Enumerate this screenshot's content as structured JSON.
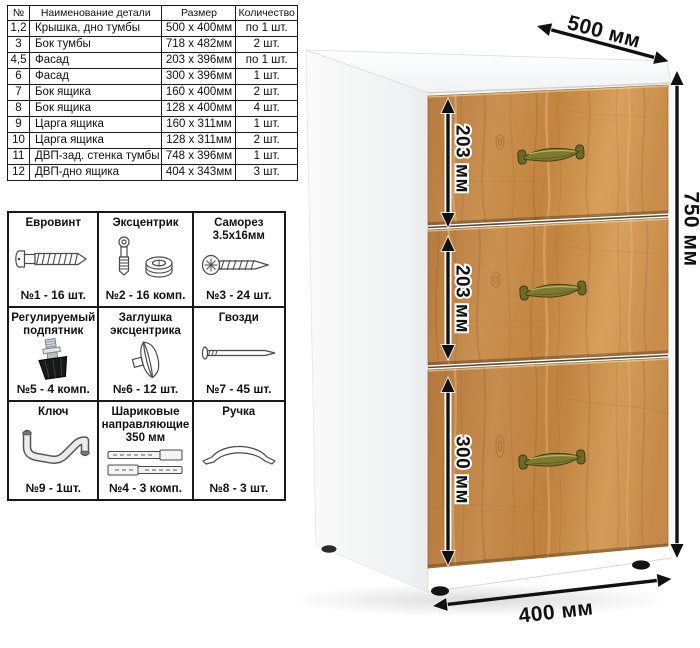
{
  "parts_table": {
    "headers": [
      "№",
      "Наименование детали",
      "Размер",
      "Количество"
    ],
    "rows": [
      {
        "num": "1,2",
        "name": "Крышка, дно тумбы",
        "size": "500 x 400мм",
        "qty": "по 1 шт."
      },
      {
        "num": "3",
        "name": "Бок тумбы",
        "size": "718 x 482мм",
        "qty": "2 шт."
      },
      {
        "num": "4,5",
        "name": "Фасад",
        "size": "203 x 396мм",
        "qty": "по 1 шт."
      },
      {
        "num": "6",
        "name": "Фасад",
        "size": "300 x 396мм",
        "qty": "1 шт."
      },
      {
        "num": "7",
        "name": "Бок ящика",
        "size": "160 x 400мм",
        "qty": "2 шт."
      },
      {
        "num": "8",
        "name": "Бок ящика",
        "size": "128 x 400мм",
        "qty": "4 шт."
      },
      {
        "num": "9",
        "name": "Царга ящика",
        "size": "160 x 311мм",
        "qty": "1 шт."
      },
      {
        "num": "10",
        "name": "Царга ящика",
        "size": "128 x 311мм",
        "qty": "2 шт."
      },
      {
        "num": "11",
        "name": "ДВП-зад. стенка тумбы",
        "size": "748 x 396мм",
        "qty": "1 шт."
      },
      {
        "num": "12",
        "name": "ДВП-дно ящика",
        "size": "404 x 343мм",
        "qty": "3 шт."
      }
    ]
  },
  "hardware": {
    "cells": [
      {
        "title": "Евровинт",
        "icon": "euro-screw-icon",
        "count": "№1 - 16 шт."
      },
      {
        "title": "Эксцентрик",
        "icon": "cam-lock-icon",
        "count": "№2 - 16 комп."
      },
      {
        "title": "Саморез 3.5х16мм",
        "icon": "self-tapping-screw-icon",
        "count": "№3 - 24 шт."
      },
      {
        "title": "Регулируемый подпятник",
        "icon": "adjustable-foot-icon",
        "count": "№5 - 4 комп."
      },
      {
        "title": "Заглушка эксцентрика",
        "icon": "cam-cover-icon",
        "count": "№6 - 12 шт."
      },
      {
        "title": "Гвозди",
        "icon": "nail-icon",
        "count": "№7 - 45 шт."
      },
      {
        "title": "Ключ",
        "icon": "hex-key-icon",
        "count": "№9 - 1шт."
      },
      {
        "title": "Шариковые направляющие 350 мм",
        "icon": "ball-bearing-slides-icon",
        "count": "№4 - 3 комп."
      },
      {
        "title": "Ручка",
        "icon": "handle-icon",
        "count": "№8 - 3 шт."
      }
    ]
  },
  "cabinet": {
    "dimensions": {
      "width": "500 мм",
      "height": "750 мм",
      "depth": "400 мм",
      "drawer_top": "203 мм",
      "drawer_middle": "203 мм",
      "drawer_bottom": "300 мм"
    }
  },
  "colors": {
    "wood": "#c68e4c",
    "wood_grain": "#8a5a28",
    "handle_brass": "#7d7930",
    "dimension_arrow": "#111111",
    "table_border": "#1a1a1a",
    "carcass_white": "#ffffff"
  }
}
